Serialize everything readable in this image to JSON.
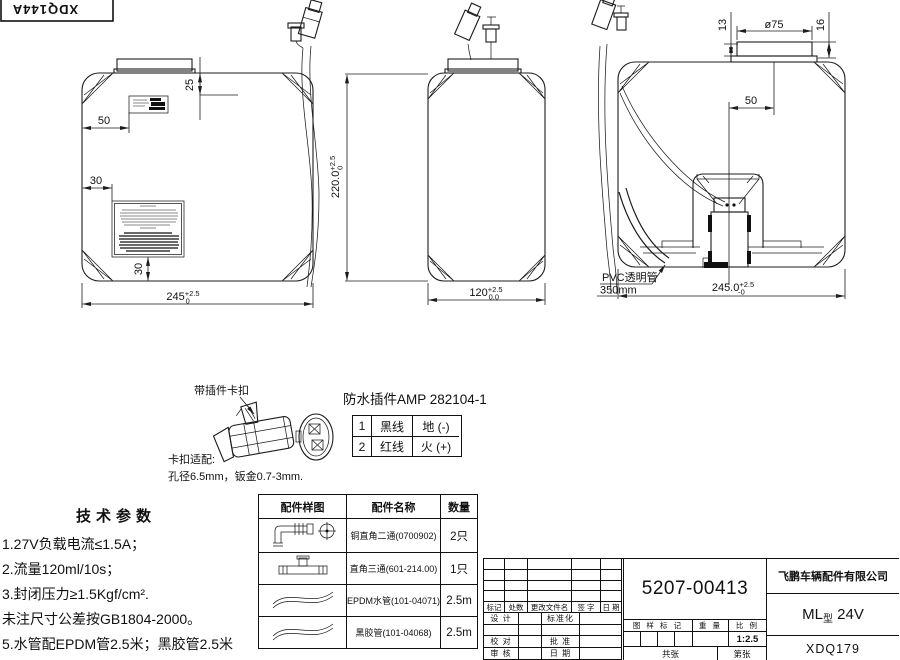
{
  "doc_id": "XDQ144A",
  "views": {
    "front": {
      "cap_offset": "25",
      "label_offset": "50",
      "label2_offset": "30",
      "label_bottom_offset": "30",
      "width_dim": {
        "main": "245",
        "sup": "+2.5",
        "sub": "0"
      },
      "height_dim": {
        "main": "220.0",
        "sup": "+2.5",
        "sub": "0"
      }
    },
    "side": {
      "width_dim": {
        "main": "120",
        "sup": "+2.5",
        "sub": "0.0"
      }
    },
    "rear": {
      "cap_h1": "13",
      "cap_dia": "ø75",
      "cap_h2": "16",
      "cap_offset": "50",
      "width_dim": {
        "main": "245.0",
        "sup": "+2.5",
        "sub": "-0"
      },
      "pvc_label": "PVC透明管",
      "pvc_length": "350mm"
    }
  },
  "connector_detail": {
    "clip_label": "带插件卡扣",
    "title": "防水插件AMP 282104-1",
    "pins": [
      {
        "no": "1",
        "wire": "黑线",
        "polarity": "地 (-)"
      },
      {
        "no": "2",
        "wire": "红线",
        "polarity": "火 (+)"
      }
    ],
    "fit_title": "卡扣适配:",
    "fit_note": "孔径6.5mm，钣金0.7-3mm."
  },
  "tech_params": {
    "title": "技术参数",
    "lines": [
      "1.27V负载电流≤1.5A；",
      "2.流量120ml/10s；",
      "3.封闭压力≥1.5Kgf/cm².",
      "未注尺寸公差按GB1804-2000。",
      "5.水管配EPDM管2.5米；黑胶管2.5米"
    ]
  },
  "parts_table": {
    "headers": [
      "配件样图",
      "配件名称",
      "数量"
    ],
    "rows": [
      {
        "icon": "elbow-fitting-icon",
        "name": "铜直角二通(0700902)",
        "qty": "2只"
      },
      {
        "icon": "tee-fitting-icon",
        "name": "直角三通(601-214.00)",
        "qty": "1只"
      },
      {
        "icon": "hose-icon",
        "name": "EPDM水管(101-04071)",
        "qty": "2.5m"
      },
      {
        "icon": "hose-icon",
        "name": "黑胶管(101-04068)",
        "qty": "2.5m"
      }
    ]
  },
  "title_block": {
    "part_number": "5207-00413",
    "company": "飞鹏车辆配件有限公司",
    "model_prefix": "ML",
    "model_type": "型",
    "model_suffix": "24V",
    "code": "XDQ179",
    "scale_value": "1:2.5",
    "rev_headers": [
      "标记",
      "处数",
      "更改文件名",
      "签 字",
      "日 期"
    ],
    "sig": {
      "design": "设 计",
      "standardize": "标准化",
      "proof": "校 对",
      "approve": "批 准",
      "review": "审 核",
      "date": "日 期"
    },
    "mark_label": "图 样 标 记",
    "weight_label": "重 量",
    "scale_label": "比 例",
    "sheets": {
      "total_l": "共",
      "total_r": "张",
      "page_l": "第",
      "page_r": "张"
    }
  }
}
